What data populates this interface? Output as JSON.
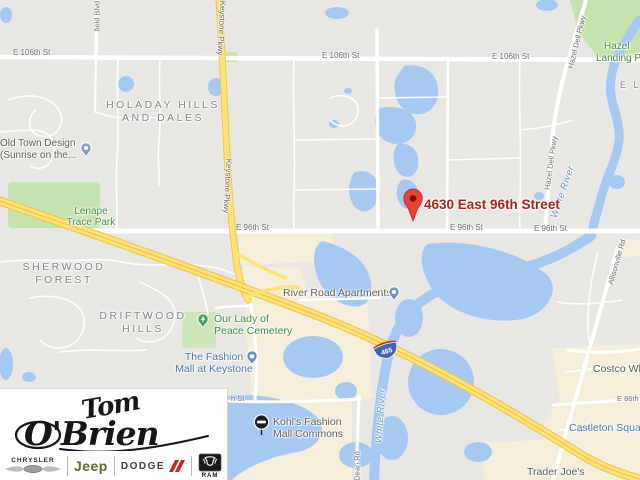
{
  "map": {
    "marker": {
      "address": "4630 East 96th Street"
    },
    "shield": {
      "route": "465"
    },
    "streets": {
      "e106": "E 106th St",
      "e96": "E 96th St",
      "e86": "E 86th St",
      "keystone": "Keystone Pkwy",
      "hazel_dell": "Hazel Dell Pkwy",
      "field_blvd": "field Blvd",
      "allisonville": "Allisonville Rd",
      "dean": "Dean Rd",
      "h_st": "h St"
    },
    "neighborhoods": {
      "holaday_1": "HOLADAY HILLS",
      "holaday_2": "AND DALES",
      "sherwood_1": "SHERWOOD",
      "sherwood_2": "FOREST",
      "driftwood_1": "DRIFTWOOD",
      "driftwood_2": "HILLS",
      "el_partial": "E L"
    },
    "parks": {
      "lenape_1": "Lenape",
      "lenape_2": "Trace Park",
      "hazel_landing_1": "Hazel",
      "hazel_landing_2": "Landing Par",
      "cemetery_1": "Our Lady of",
      "cemetery_2": "Peace Cemetery"
    },
    "pois": {
      "old_town_1": "Old Town Design",
      "old_town_2": "(Sunrise on the...",
      "river_road": "River Road Apartments",
      "fashion_mall_1": "The Fashion",
      "fashion_mall_2": "Mall at Keystone",
      "kohls_1": "Kohl's Fashion",
      "kohls_2": "Mall Commons",
      "costco": "Costco Wh",
      "castleton": "Castleton Squar",
      "trader_joes": "Trader Joe's"
    },
    "water": {
      "white_river": "White River"
    }
  },
  "logo": {
    "script_1": "Tom",
    "script_2": "O'Brien",
    "brands": {
      "chrysler": "CHRYSLER",
      "jeep": "Jeep",
      "dodge": "DODGE",
      "ram": "RAM"
    }
  },
  "colors": {
    "marker_red": "#ea4335",
    "address_text": "#a6261b",
    "highway_yellow": "#ffe372",
    "water_blue": "#a6c9f2",
    "park_green": "#c5e3ad",
    "commercial_cream": "#f5eedb",
    "shield_blue": "#3b66ae",
    "shield_red": "#c03a2b",
    "jeep_green": "#5d6b2a",
    "dodge_red": "#cc2229"
  }
}
